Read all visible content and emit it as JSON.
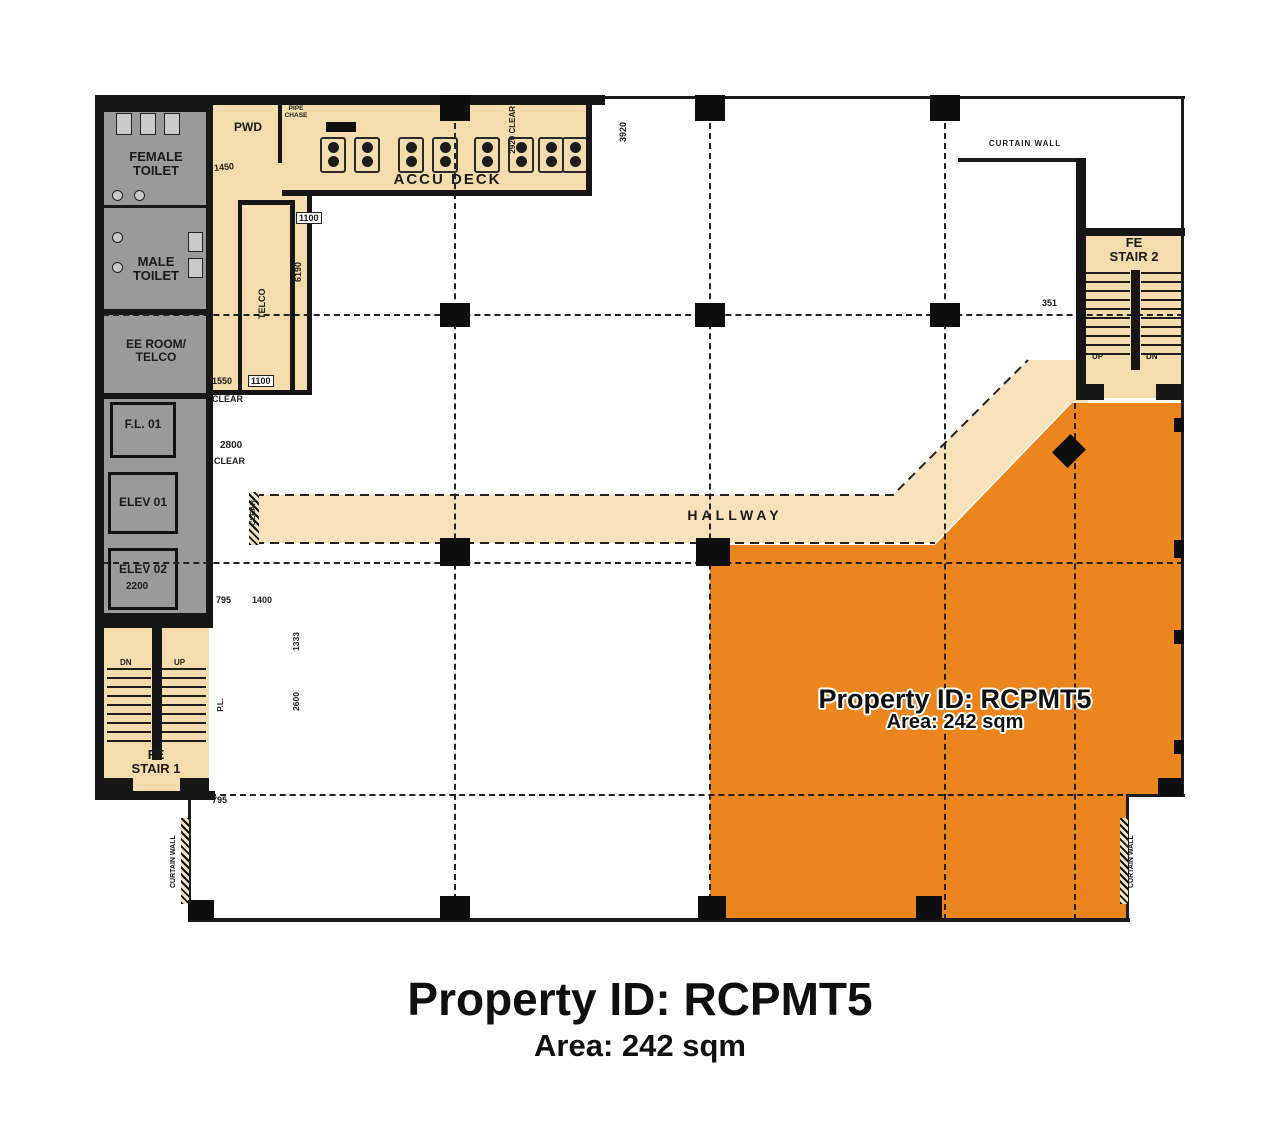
{
  "caption": {
    "line1": "Property ID: RCPMT5",
    "line2": "Area: 242 sqm"
  },
  "highlight_overlay": {
    "line1": "Property ID: RCPMT5",
    "line2": "Area: 242 sqm"
  },
  "colors": {
    "highlight_orange": "#ED851F",
    "room_beige": "#F4DCAC",
    "hallway_beige": "#F8E2BB",
    "core_gray": "#9A9A9A",
    "wall_black": "#161616"
  },
  "rooms": {
    "female_toilet_l1": "FEMALE",
    "female_toilet_l2": "TOILET",
    "male_toilet_l1": "MALE",
    "male_toilet_l2": "TOILET",
    "ee_room_l1": "EE ROOM/",
    "ee_room_l2": "TELCO",
    "fl01": "F.L. 01",
    "elev1": "ELEV 01",
    "elev2": "ELEV 02",
    "pwd": "PWD",
    "pipe_chase_l1": "PIPE",
    "pipe_chase_l2": "CHASE",
    "accu_deck": "ACCU DECK",
    "telco_shaft": "TELCO",
    "hallway": "HALLWAY",
    "stair2_l1": "FE",
    "stair2_l2": "STAIR 2",
    "stair1_l1": "FE",
    "stair1_l2": "STAIR 1"
  },
  "annotations": {
    "curtain_wall": "CURTAIN WALL",
    "up": "UP",
    "dn": "DN",
    "pl": "P.L.",
    "clear": "CLEAR"
  },
  "dimensions": {
    "d1450": "1450",
    "d2920clear": "2920 CLEAR",
    "d3920": "3920",
    "d1100a": "1100",
    "d6190": "6190",
    "d1550": "1550",
    "d1100b": "1100",
    "d2800": "2800",
    "d795a": "795",
    "d1400": "1400",
    "d1333": "1333",
    "d2600": "2600",
    "d795b": "795",
    "d351": "351",
    "d2200": "2200"
  }
}
